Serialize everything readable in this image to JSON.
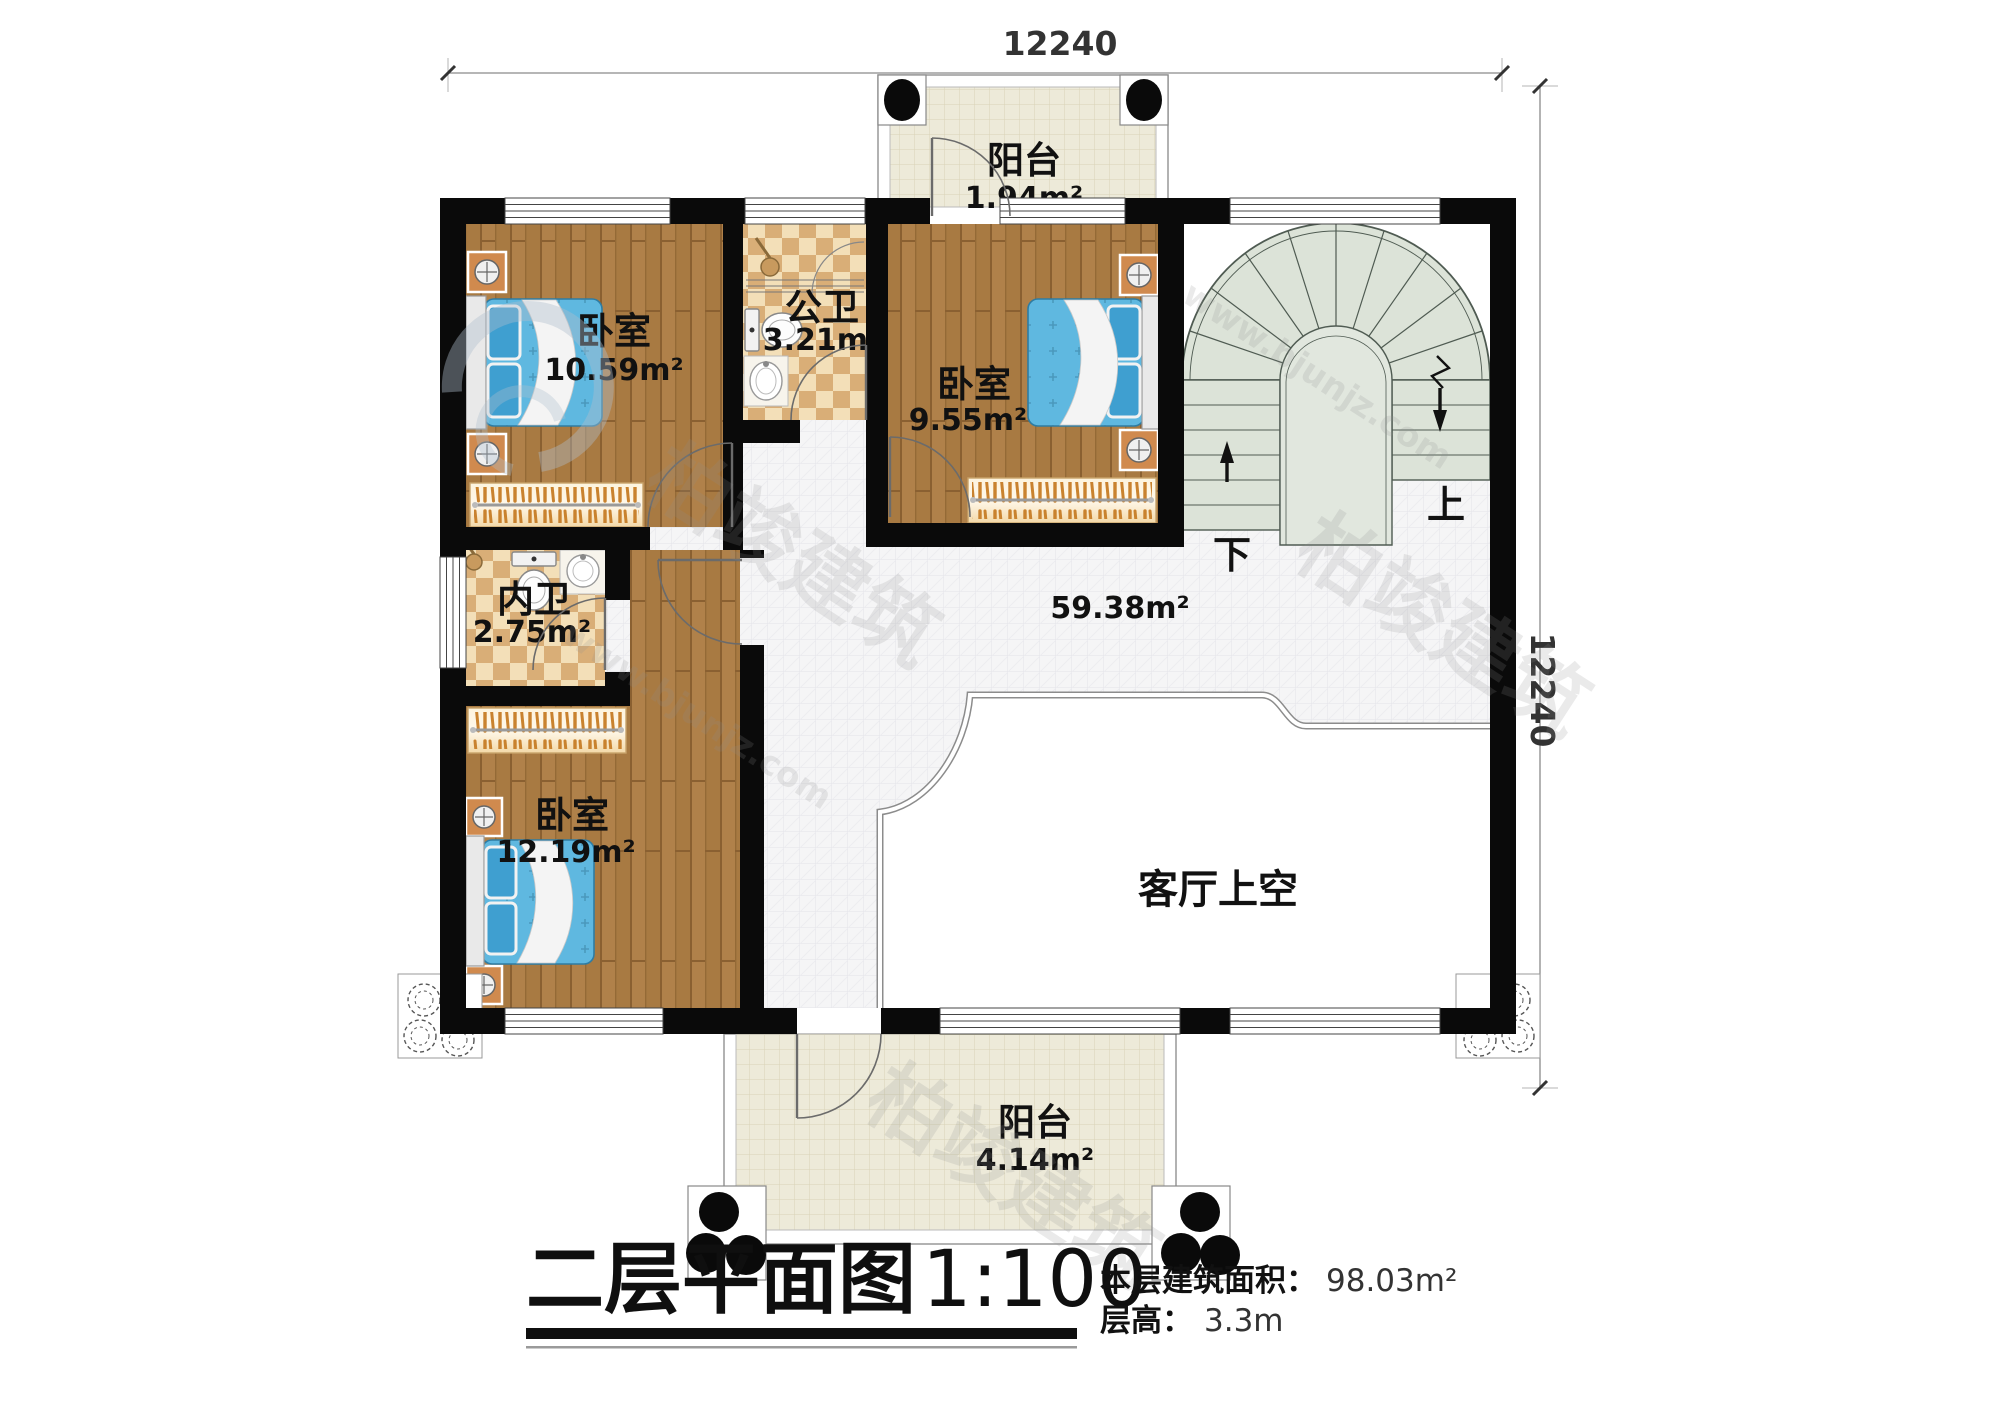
{
  "plan": {
    "dimensions": {
      "top": "12240",
      "right": "12240"
    },
    "rooms": {
      "balcony_top": {
        "name": "阳台",
        "area": "1.94m²"
      },
      "bedroom_nw": {
        "name": "卧室",
        "area": "10.59m²"
      },
      "bath_public": {
        "name": "公卫",
        "area": "3.21m²"
      },
      "bedroom_n": {
        "name": "卧室",
        "area": "9.55m²"
      },
      "bath_private": {
        "name": "内卫",
        "area": "2.75m²"
      },
      "bedroom_sw": {
        "name": "卧室",
        "area": "12.19m²"
      },
      "hall": {
        "area": "59.38m²"
      },
      "living_void": {
        "name": "客厅上空"
      },
      "balcony_bottom": {
        "name": "阳台",
        "area": "4.14m²"
      }
    },
    "stairs": {
      "up": "上",
      "down": "下"
    }
  },
  "titleblock": {
    "title": "二层平面图",
    "scale": "1:100",
    "area_label": "本层建筑面积：",
    "area_value": "98.03m²",
    "height_label": "层高：",
    "height_value": "3.3m"
  },
  "watermark": {
    "brand": "柏竣建筑",
    "url": "www.bjunjz.com"
  },
  "colors": {
    "wall": "#0a0a0a",
    "wood_floor": "#a87a42",
    "bath_tile_light": "#f3dfb8",
    "bath_tile_dark": "#d9ae77",
    "hall_tile": "#f4f4f6",
    "balcony_tile": "#edead9",
    "stair": "#dce3d8",
    "bed_blue": "#5fb8e0",
    "pillow_blue": "#3f9fd0",
    "nightstand_orange": "#d08a4e"
  }
}
